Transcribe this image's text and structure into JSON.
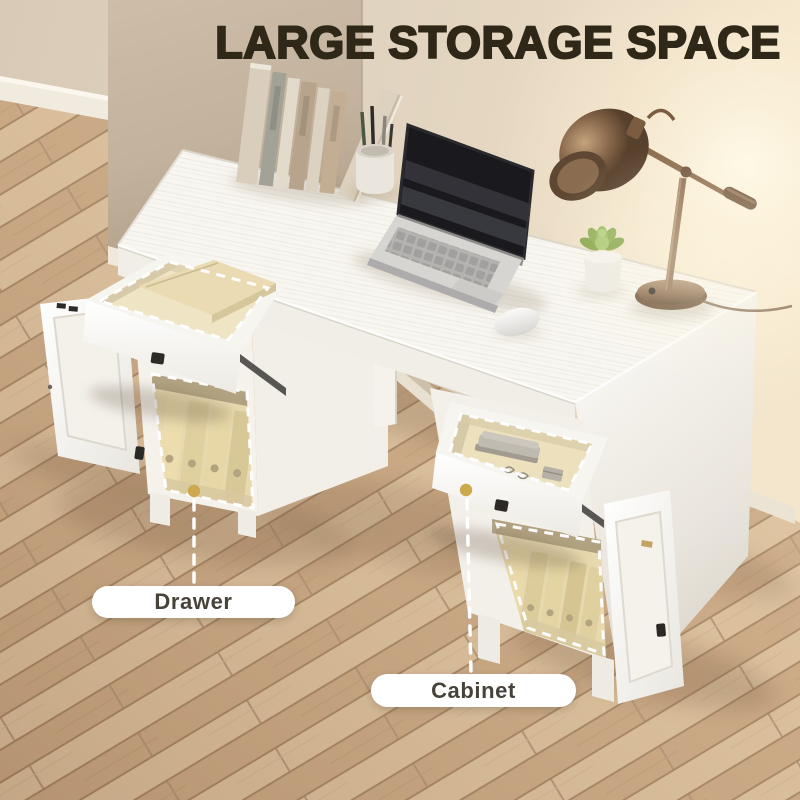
{
  "image": {
    "type": "product-marketing-photo",
    "headline": "LARGE STORAGE SPACE"
  },
  "callouts": [
    {
      "label": "Drawer"
    },
    {
      "label": "Cabinet"
    }
  ],
  "colors": {
    "headline_text": "#2f2818",
    "wall": "#ddd0bd",
    "wall_glow": "#f8eed8",
    "floor_plank_light": "#d8bb97",
    "floor_plank_dark": "#c4a17c",
    "desk_white": "#f8f6f1",
    "drawer_interior": "#efe4c3",
    "file_binder": "#e8d8a8",
    "leader_dot_gold": "#cda94e",
    "leader_line": "#ffffff",
    "label_pill_bg": "#ffffff",
    "label_text": "#48433a",
    "lamp_bronze": "#8a6a4c",
    "plant_green": "#8fae54"
  },
  "scene_items": [
    "row-of-books",
    "pencil-cup",
    "open-laptop",
    "computer-mouse",
    "potted-succulent",
    "desk-lamp",
    "white-desk",
    "open-drawer-left",
    "storage-box-in-drawer",
    "open-cabinet-left",
    "file-binders",
    "open-drawer-right",
    "stapler",
    "open-cabinet-right"
  ]
}
